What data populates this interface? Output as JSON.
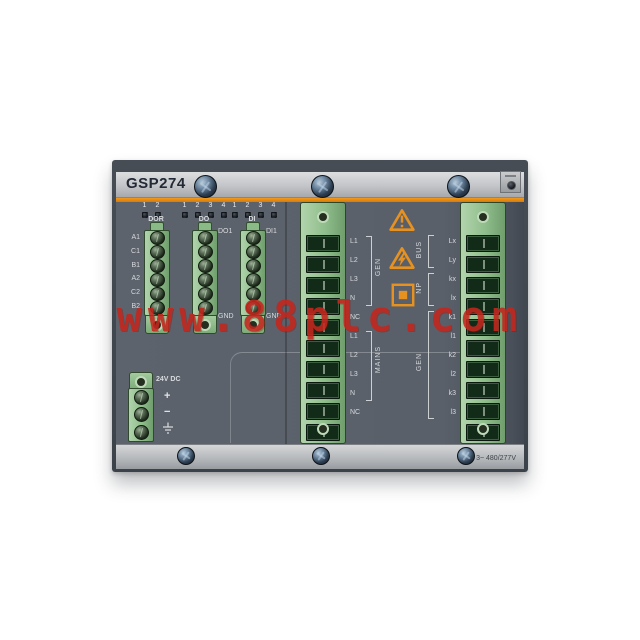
{
  "device": {
    "model": "GSP274",
    "rating": "3~ 480/277V"
  },
  "watermark": {
    "text": "www.88plc.com",
    "color": "#c4261d"
  },
  "colors": {
    "accent_orange": "#e2830e",
    "connector_green": "#8fbd8b",
    "body_gray": "#5d636c",
    "watermark_red": "#c4261d"
  },
  "led_row": {
    "dor": [
      "1",
      "2"
    ],
    "do": [
      "1",
      "2",
      "3",
      "4"
    ],
    "di": [
      "1",
      "2",
      "3",
      "4"
    ]
  },
  "io": {
    "dor": {
      "label": "DOR",
      "pins": [
        "A1",
        "C1",
        "B1",
        "A2",
        "C2",
        "B2"
      ]
    },
    "do": {
      "label": "DO",
      "plug": "DO1",
      "gnd": "GND"
    },
    "di": {
      "label": "DI",
      "plug": "DI1",
      "gnd": "GND"
    }
  },
  "power": {
    "label": "24V DC",
    "plus": "+",
    "minus": "−"
  },
  "measure": {
    "left": {
      "pins": [
        "L1",
        "L2",
        "L3",
        "N",
        "NC",
        "L1",
        "L2",
        "L3",
        "N",
        "NC"
      ],
      "brackets": [
        {
          "label": "GEN"
        },
        {
          "label": "MAINS"
        }
      ]
    },
    "right": {
      "pins": [
        "Lx",
        "Ly",
        "kx",
        "lx",
        "k1",
        "l1",
        "k2",
        "l2",
        "k3",
        "l3"
      ],
      "brackets": [
        {
          "label": "BUS"
        },
        {
          "label": "NP"
        },
        {
          "label": "GEN"
        }
      ]
    }
  },
  "safety_icons": [
    "general-warning",
    "electric-shock-warning",
    "double-insulation"
  ]
}
